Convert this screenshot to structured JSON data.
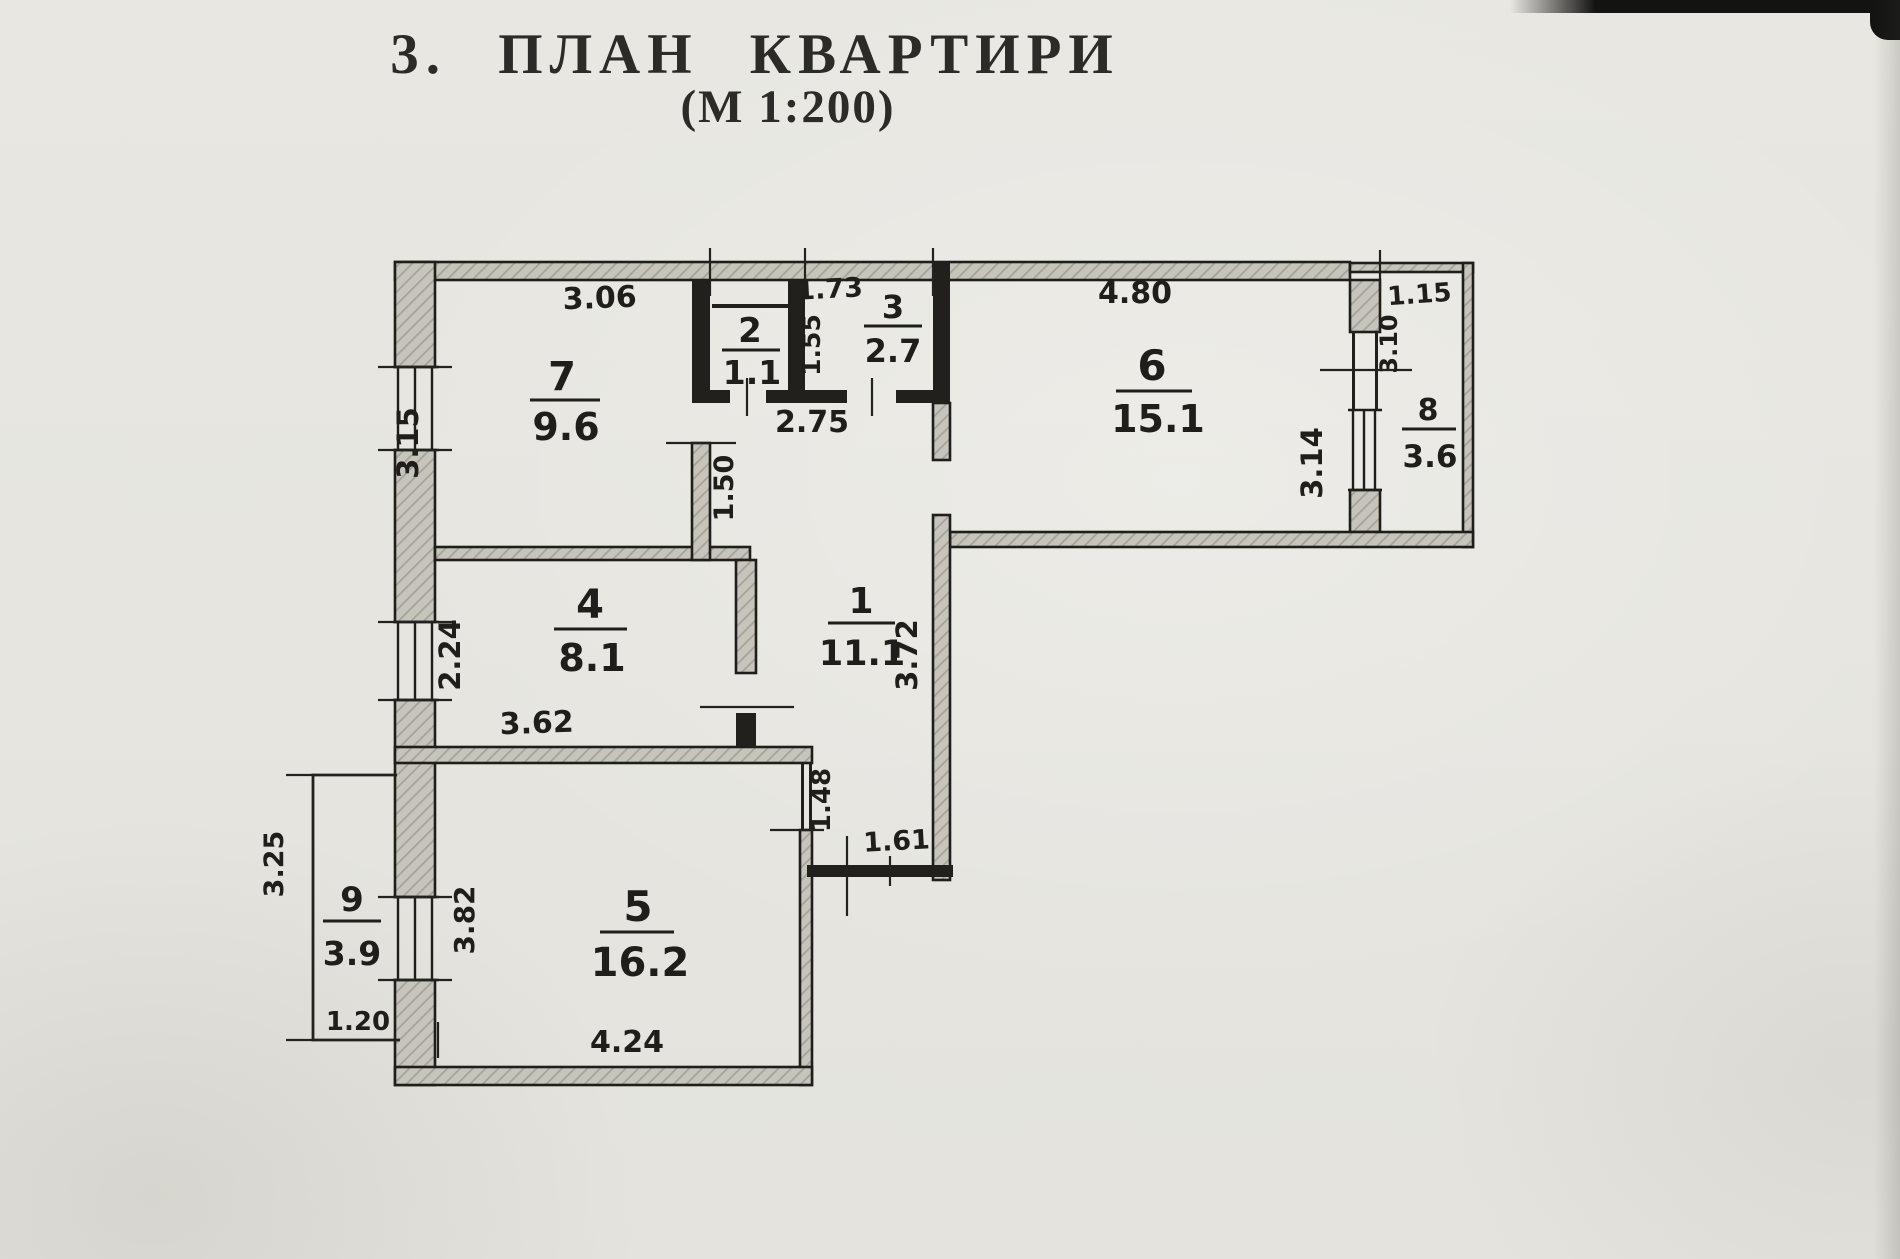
{
  "title": "3. ПЛАН КВАРТИРИ",
  "subtitle": "(М 1:200)",
  "rooms": {
    "r1": {
      "number": "1",
      "area": "11.1"
    },
    "r2": {
      "number": "2",
      "area": "1.1"
    },
    "r3": {
      "number": "3",
      "area": "2.7"
    },
    "r4": {
      "number": "4",
      "area": "8.1"
    },
    "r5": {
      "number": "5",
      "area": "16.2"
    },
    "r6": {
      "number": "6",
      "area": "15.1"
    },
    "r7": {
      "number": "7",
      "area": "9.6"
    },
    "r8": {
      "number": "8",
      "area": "3.6"
    },
    "r9": {
      "number": "9",
      "area": "3.9"
    }
  },
  "dims": {
    "room7_top": "3.06",
    "room7_left": "3.15",
    "room3_top": "1.73",
    "room3_left": "1.55",
    "room6_top": "4.80",
    "room6_right": "3.14",
    "room8_top": "1.15",
    "room8_left": "3.10",
    "hall_top": "2.75",
    "hall_left": "1.50",
    "room4_left": "2.24",
    "room4_bottom": "3.62",
    "room1_right": "3.72",
    "room1_lower_left": "1.48",
    "room1_bottom": "1.61",
    "room5_left": "3.82",
    "room5_bottom": "4.24",
    "room9_left": "3.25",
    "room9_bottom": "1.20"
  },
  "colors": {
    "ink": "#1f1e1b",
    "wall_fill": "#c6c4bb",
    "paper": "#e8e7e1"
  }
}
